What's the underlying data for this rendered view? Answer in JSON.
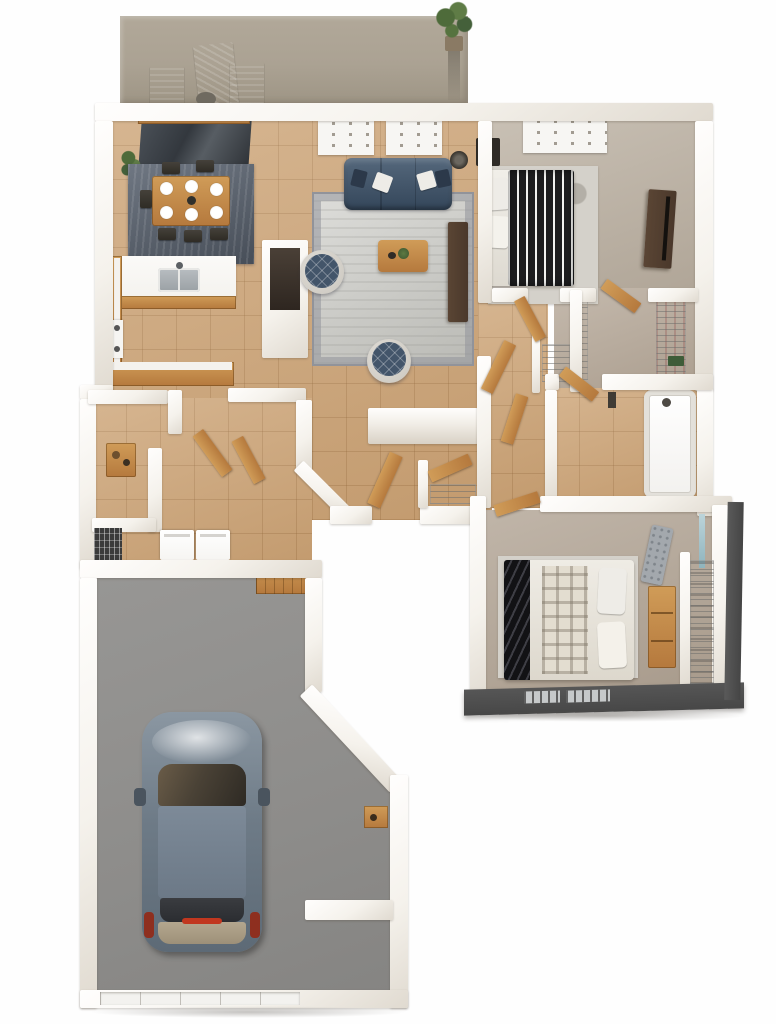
{
  "image_type": "3D top-down floor plan rendering of a single-story home with attached garage; no text labels are visible",
  "colors": {
    "bg": "#fefefe",
    "wall": "#f5f2ec",
    "deck": "#aba293",
    "deck_dark": "#9e9585",
    "tile": "#cda578",
    "rug_dining": "#5b6471",
    "rug_living": "#cbcbc6",
    "rug_living_border": "#91939a",
    "rug_marble": "#d4d1ca",
    "sofa": "#43556a",
    "sofa_dark": "#34465a",
    "pillow_white": "#eeece7",
    "wood": "#b5793d",
    "wood_light": "#d09c58",
    "wood_dark": "#4a382b",
    "counter_white": "#f4f2ee",
    "carpet_master": "#beb4a6",
    "carpet_closet": "#b9ac9d",
    "carpet_bed2": "#b4a798",
    "duvet_dark": "#1d1d1f",
    "garage_floor": "#8d8c8a",
    "car_body": "#6e7b87",
    "car_roof": "#7d8a98",
    "car_glass": "#4a4236",
    "car_trunk": "#b4a78f",
    "taillight": "#8e2f1f",
    "dark_wall": "#474747",
    "window_slit": "#c6c9ca",
    "plant_green": "#4e6b3a",
    "bench_gray": "#a3a8ad",
    "mirror_blue": "#bcd4da",
    "tub_white": "#f2f1ee",
    "black_furniture": "#2e2a26",
    "appliance_white": "#f6f5f2",
    "shadow": "#e5e3e1"
  },
  "rooms": [
    {
      "name": "patio deck",
      "furniture": [
        "outdoor lounge chair",
        "two outdoor armchairs",
        "potted plant"
      ]
    },
    {
      "name": "dining room",
      "furniture": [
        "wood dining table",
        "six white place settings",
        "dark area rug",
        "dining chairs",
        "sliding glass door",
        "potted plant"
      ]
    },
    {
      "name": "kitchen",
      "furniture": [
        "U-shaped wood cabinets with white counters",
        "sink with faucet",
        "cooktop",
        "pantry nook"
      ]
    },
    {
      "name": "living room",
      "furniture": [
        "navy three-seat sofa with throw pillows",
        "bordered gray area rug",
        "wood coffee table with plant",
        "two round quilted accent chairs",
        "dark media console",
        "floor lamp",
        "two slatted windows"
      ]
    },
    {
      "name": "master bedroom",
      "furniture": [
        "bed with black-and-white striped duvet",
        "white pillows",
        "marble area rug",
        "dark nightstand",
        "dark dresser with TV",
        "slatted window"
      ]
    },
    {
      "name": "walk-in closet",
      "furniture": [
        "wire shelving on both sides",
        "green storage bin",
        "wood door"
      ]
    },
    {
      "name": "linen closet",
      "furniture": [
        "wire shelf"
      ]
    },
    {
      "name": "bathroom",
      "furniture": [
        "bathtub with shower",
        "tile floor",
        "wood door"
      ]
    },
    {
      "name": "hallway",
      "furniture": [
        "open wood doors",
        "hall closet with wire shelf"
      ]
    },
    {
      "name": "entry and laundry",
      "furniture": [
        "washer",
        "dryer",
        "black drying rack",
        "wood console table",
        "front door"
      ]
    },
    {
      "name": "bedroom two",
      "furniture": [
        "bed with plaid blanket and dark striped throw",
        "gray tufted bench",
        "wood dresser",
        "mirror",
        "closet with wire shelving",
        "dark exterior wall with windows"
      ]
    },
    {
      "name": "garage",
      "furniture": [
        "blue-gray sedan seen from above",
        "small wood wall shelf",
        "work ledge",
        "garage door"
      ]
    }
  ]
}
